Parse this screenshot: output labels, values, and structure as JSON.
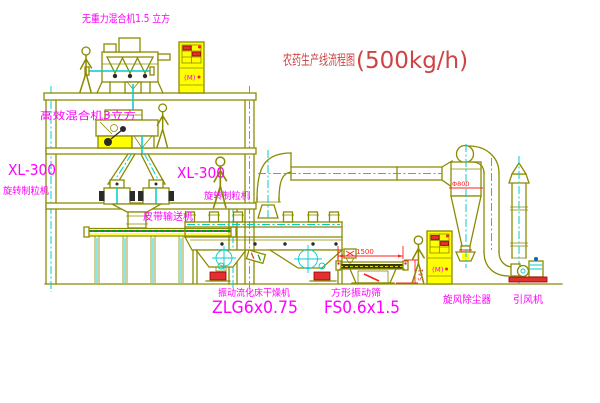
{
  "title": {
    "name_cn": "农药生产线流程图",
    "capacity": "(500kg/h)"
  },
  "equipment_labels": {
    "gravity_mixer": "无重力混合机1.5 立方",
    "high_eff_mixer": "高效混合机3立方",
    "granulator_left_model": "XL-300",
    "granulator_left_name": "旋转制粒机",
    "granulator_mid_model": "XL-300",
    "granulator_mid_name": "旋转制粒机",
    "belt_conveyor": "皮带输送机",
    "dryer_name": "振动流化床干燥机",
    "dryer_model": "ZLG6x0.75",
    "screen_name": "方形振动筛",
    "screen_model": "FS0.6x1.5",
    "cyclone_name": "旋风除尘器",
    "fan_name": "引风机"
  },
  "dimensions": {
    "screen_length": "1500",
    "screen_height": "541",
    "cyclone_marking": "Φ800"
  },
  "cabinet_marking": "(M)",
  "colors": {
    "background": "#FFFFFF",
    "line": "#8B8B00",
    "cyan": "#00CCCC",
    "label": "#FF00FF",
    "title": "#CC4444",
    "yellow": "#FFFF00",
    "green": "#00A000",
    "red": "#FF2020"
  }
}
